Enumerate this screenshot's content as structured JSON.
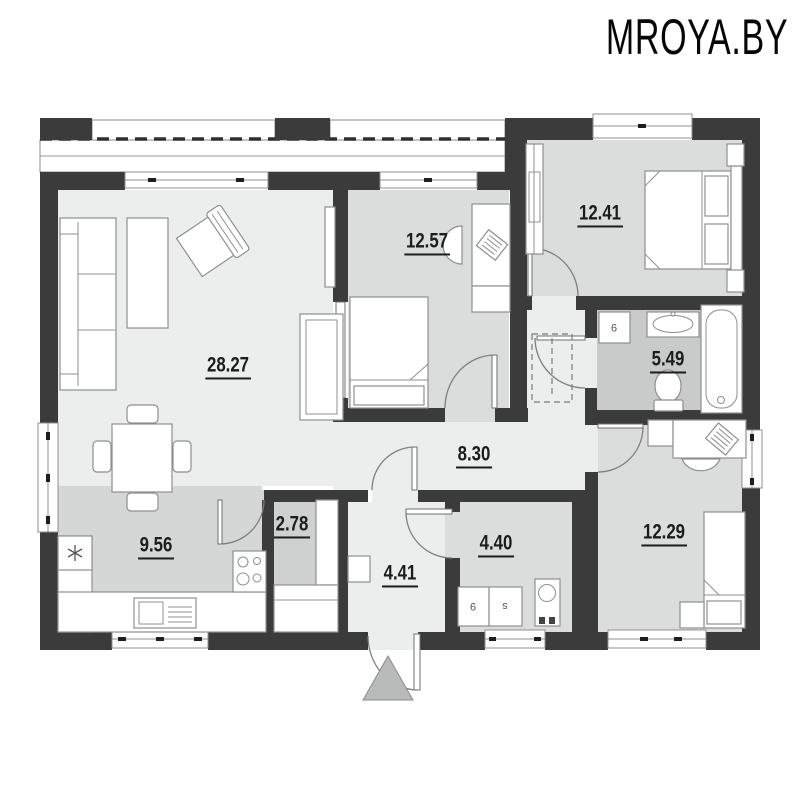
{
  "brand": {
    "logo_text": "MROYA.BY"
  },
  "rooms": [
    {
      "name": "living-room",
      "area_m2": "28.27"
    },
    {
      "name": "bedroom-top",
      "area_m2": "12.57"
    },
    {
      "name": "bedroom-right",
      "area_m2": "12.41"
    },
    {
      "name": "bathroom",
      "area_m2": "5.49"
    },
    {
      "name": "hallway",
      "area_m2": "8.30"
    },
    {
      "name": "pantry",
      "area_m2": "2.78"
    },
    {
      "name": "kitchen",
      "area_m2": "9.56"
    },
    {
      "name": "entry-hall",
      "area_m2": "4.41"
    },
    {
      "name": "utility-room",
      "area_m2": "4.40"
    },
    {
      "name": "bedroom-bottom",
      "area_m2": "12.29"
    }
  ],
  "appliance_marks": {
    "bath_washer": "9",
    "utility_washer": "9",
    "utility_dryer": "s"
  },
  "icons": {
    "fridge": "snowflake-icon",
    "entrance": "entrance-triangle-marker"
  },
  "palette": {
    "wall": "#3b3b3b",
    "floor_light": "#eceded",
    "floor_mid": "#dbdcdc",
    "floor_kitchen": "#d5d6d6",
    "floor_bath": "#c9caca",
    "floor_pantry": "#cfd0d0",
    "label_text": "#1c1c1c",
    "logo_text": "#060606"
  }
}
